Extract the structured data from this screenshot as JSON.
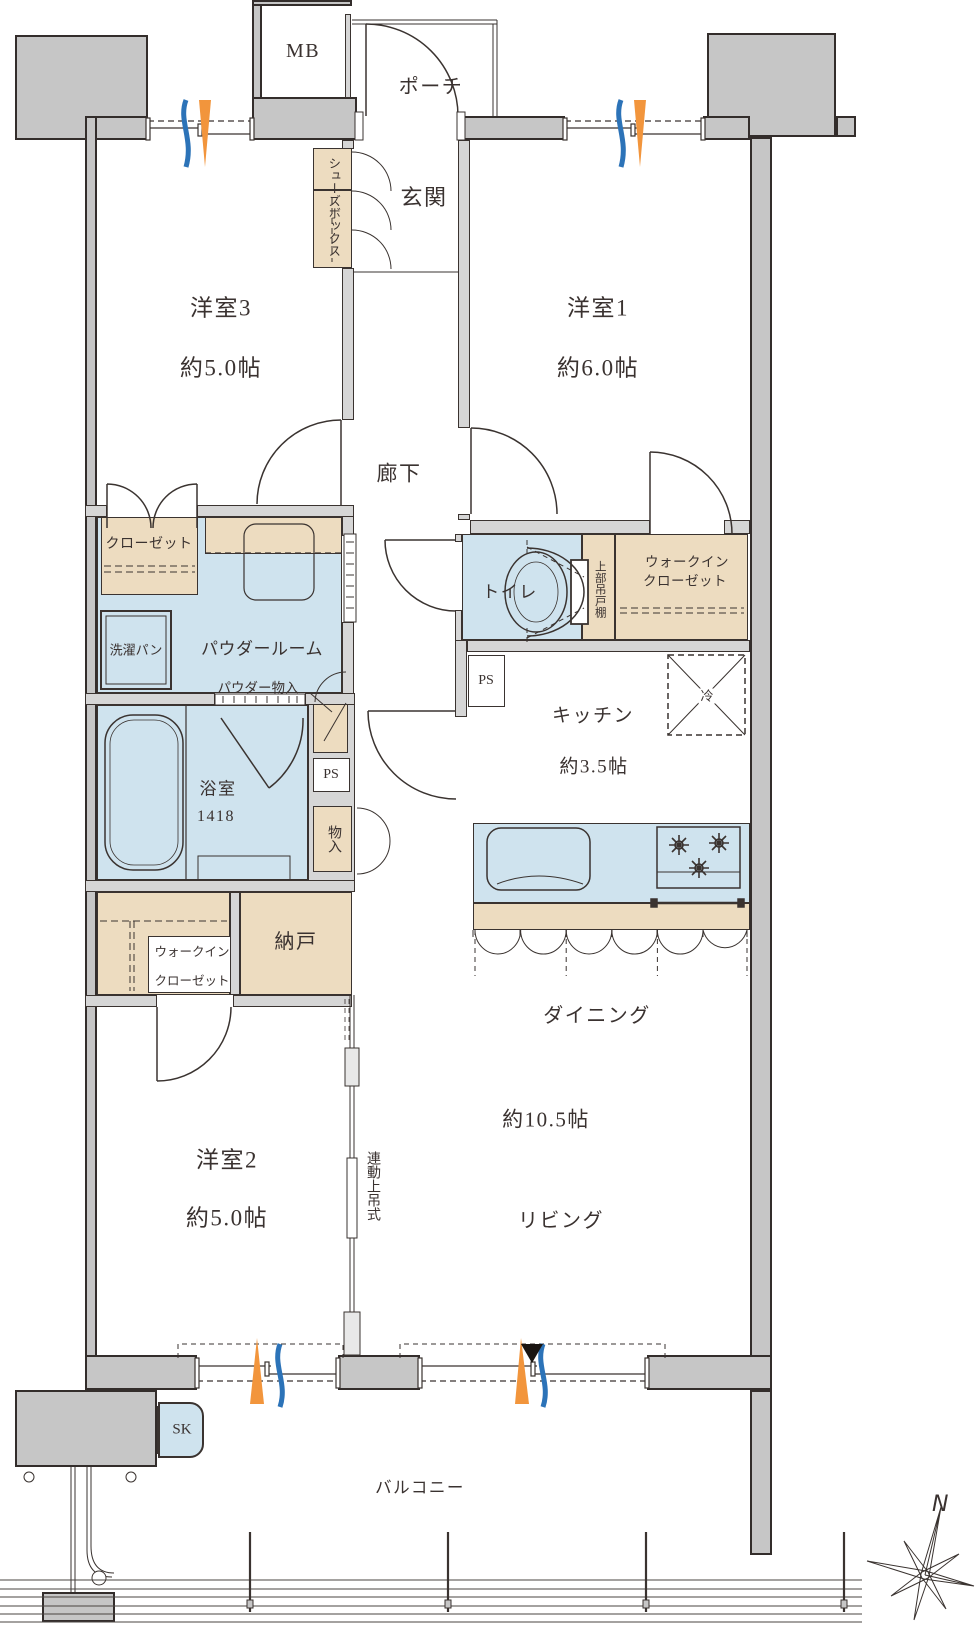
{
  "rooms": {
    "yoshitsu3": {
      "name": "洋室3",
      "area": "約5.0帖"
    },
    "yoshitsu1": {
      "name": "洋室1",
      "area": "約6.0帖"
    },
    "yoshitsu2": {
      "name": "洋室2",
      "area": "約5.0帖"
    },
    "kitchen": {
      "name": "キッチン",
      "area": "約3.5帖"
    },
    "living_dining": {
      "dining": "ダイニング",
      "area": "約10.5帖",
      "living": "リビング"
    },
    "bathroom": {
      "name": "浴室",
      "size": "1418"
    },
    "powder_room": {
      "name": "パウダールーム"
    },
    "toilet": {
      "name": "トイレ"
    },
    "corridor": {
      "name": "廊下"
    },
    "genkan": {
      "name": "玄関"
    },
    "porch": {
      "name": "ポーチ"
    },
    "nando": {
      "name": "納戸"
    },
    "balcony": {
      "name": "バルコニー"
    }
  },
  "storage": {
    "shoes_box": "シューズボックス",
    "closet": "クローゼット",
    "walkin_closet_upper": {
      "line1": "ウォークイン",
      "line2": "クローゼット"
    },
    "walkin_closet_lower": {
      "line1": "ウォークイン",
      "line2": "クローゼット"
    },
    "upper_cabinet": "上部吊戸棚",
    "monoire": "物入",
    "powder_monoire": "パウダー物入"
  },
  "fixtures": {
    "mb": "MB",
    "ps": "PS",
    "sk": "SK",
    "laundry_pan": "洗濯パン",
    "fridge": "冷",
    "sliding_door_note": "連動上吊式"
  },
  "compass": {
    "north": "N"
  },
  "colors": {
    "wall": "#c6c6c6",
    "wet_area": "#cfe3ee",
    "storage": "#eddcc0",
    "line": "#3a3330",
    "vent_orange": "#f2953c",
    "vent_blue": "#2c73b8"
  }
}
